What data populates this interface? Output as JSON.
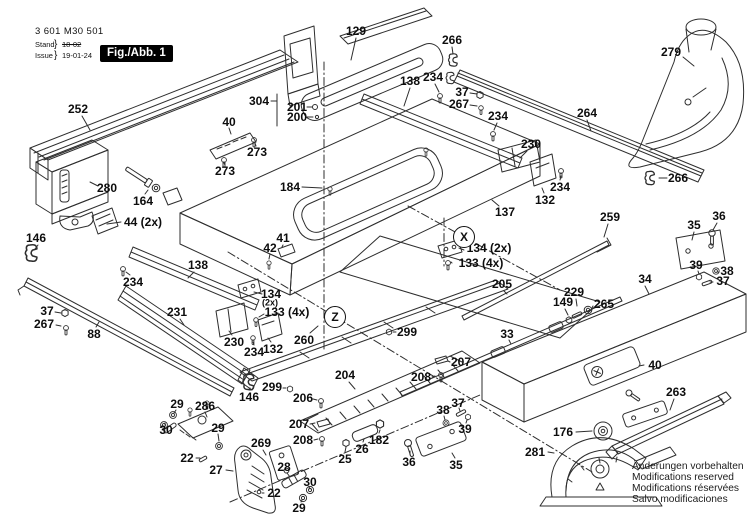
{
  "header": {
    "part_number": "3 601 M30 501",
    "revision": {
      "stand_label": "Stand",
      "issue_label": "Issue",
      "brace": "}",
      "stand_value": "18-02",
      "issue_value": "19-01-24"
    },
    "figure_label": "Fig./Abb. 1"
  },
  "brand": "BOSCH",
  "footer_note": {
    "lines": [
      "Änderungen vorbehalten",
      "Modifications reserved",
      "Modifications réservées",
      "Salvo modificaciones"
    ]
  },
  "view_markers": [
    {
      "letter": "X",
      "x": 464,
      "y": 237
    },
    {
      "letter": "Z",
      "x": 335,
      "y": 317
    }
  ],
  "part_labels": [
    {
      "t": "129",
      "x": 356,
      "y": 31,
      "l": [
        356,
        38,
        351,
        60
      ]
    },
    {
      "t": "266",
      "x": 452,
      "y": 40,
      "l": [
        452,
        47,
        453,
        54
      ]
    },
    {
      "t": "279",
      "x": 671,
      "y": 52,
      "l": [
        683,
        57,
        694,
        66
      ]
    },
    {
      "t": "252",
      "x": 78,
      "y": 109,
      "l": [
        82,
        116,
        90,
        130
      ]
    },
    {
      "t": "304",
      "x": 259,
      "y": 101,
      "l": [
        271,
        101,
        277,
        101
      ],
      "l2": [
        277,
        94,
        277,
        126
      ]
    },
    {
      "t": "201",
      "x": 297,
      "y": 107,
      "l": [
        307,
        107,
        312,
        107
      ]
    },
    {
      "t": "200",
      "x": 297,
      "y": 117,
      "l": [
        307,
        117,
        313,
        117
      ]
    },
    {
      "t": "138",
      "x": 410,
      "y": 81,
      "l": [
        410,
        88,
        404,
        106
      ]
    },
    {
      "t": "234",
      "x": 433,
      "y": 77,
      "l": [
        435,
        84,
        439,
        92
      ]
    },
    {
      "t": "37",
      "x": 462,
      "y": 92,
      "l": [
        470,
        93,
        477,
        94
      ]
    },
    {
      "t": "267",
      "x": 459,
      "y": 104,
      "l": [
        470,
        105,
        477,
        106
      ]
    },
    {
      "t": "234",
      "x": 498,
      "y": 116,
      "l": [
        497,
        123,
        494,
        130
      ]
    },
    {
      "t": "264",
      "x": 587,
      "y": 113,
      "l": [
        587,
        120,
        591,
        131
      ]
    },
    {
      "t": "40",
      "x": 229,
      "y": 122,
      "l": [
        229,
        128,
        231,
        134
      ]
    },
    {
      "t": "273",
      "x": 257,
      "y": 152,
      "l": [
        256,
        146,
        255,
        143
      ]
    },
    {
      "t": "273",
      "x": 225,
      "y": 171,
      "l": [
        225,
        165,
        224,
        163
      ]
    },
    {
      "t": "280",
      "x": 107,
      "y": 188,
      "l": [
        98,
        186,
        90,
        182
      ]
    },
    {
      "t": "164",
      "x": 143,
      "y": 201,
      "l": [
        145,
        194,
        148,
        190
      ]
    },
    {
      "t": "44 (2x)",
      "x": 143,
      "y": 222,
      "l": [
        121,
        222,
        107,
        224
      ]
    },
    {
      "t": "184",
      "x": 290,
      "y": 187,
      "l": [
        302,
        187,
        322,
        188
      ]
    },
    {
      "t": "230",
      "x": 531,
      "y": 144,
      "l": [
        527,
        151,
        520,
        158
      ]
    },
    {
      "t": "234",
      "x": 560,
      "y": 187,
      "l": [
        560,
        180,
        561,
        176
      ]
    },
    {
      "t": "132",
      "x": 545,
      "y": 200,
      "l": [
        544,
        193,
        542,
        188
      ]
    },
    {
      "t": "137",
      "x": 505,
      "y": 212,
      "l": [
        499,
        206,
        492,
        200
      ]
    },
    {
      "t": "266",
      "x": 678,
      "y": 178,
      "l": [
        667,
        178,
        659,
        178
      ]
    },
    {
      "t": "259",
      "x": 610,
      "y": 217,
      "l": [
        608,
        224,
        604,
        237
      ]
    },
    {
      "t": "36",
      "x": 719,
      "y": 216,
      "l": [
        717,
        223,
        713,
        230
      ]
    },
    {
      "t": "35",
      "x": 694,
      "y": 225,
      "l": [
        694,
        232,
        692,
        240
      ]
    },
    {
      "t": "39",
      "x": 696,
      "y": 265,
      "l": [
        698,
        271,
        699,
        274
      ]
    },
    {
      "t": "38",
      "x": 727,
      "y": 271,
      "l": [
        719,
        272,
        717,
        272
      ]
    },
    {
      "t": "37",
      "x": 723,
      "y": 281,
      "l": [
        713,
        282,
        710,
        282
      ]
    },
    {
      "t": "34",
      "x": 645,
      "y": 279,
      "l": [
        645,
        286,
        649,
        294
      ]
    },
    {
      "t": "146",
      "x": 36,
      "y": 238,
      "l": [
        38,
        245,
        35,
        249
      ]
    },
    {
      "t": "138",
      "x": 198,
      "y": 265,
      "l": [
        194,
        272,
        188,
        278
      ]
    },
    {
      "t": "234",
      "x": 133,
      "y": 282,
      "l": [
        130,
        275,
        126,
        272
      ]
    },
    {
      "t": "42",
      "x": 270,
      "y": 248,
      "l": [
        270,
        254,
        269,
        259
      ]
    },
    {
      "t": "41",
      "x": 283,
      "y": 238,
      "l": [
        283,
        245,
        282,
        247
      ]
    },
    {
      "t": "134 (2x)",
      "x": 489,
      "y": 248,
      "l": [
        459,
        248,
        464,
        250
      ]
    },
    {
      "t": "133 (4x)",
      "x": 481,
      "y": 263,
      "l": [
        452,
        263,
        451,
        262
      ]
    },
    {
      "t": "205",
      "x": 502,
      "y": 284,
      "l": [
        504,
        291,
        507,
        294
      ]
    },
    {
      "t": "229",
      "x": 574,
      "y": 292,
      "l": [
        576,
        299,
        577,
        306
      ]
    },
    {
      "t": "149",
      "x": 563,
      "y": 302,
      "l": [
        565,
        309,
        568,
        315
      ]
    },
    {
      "t": "265",
      "x": 604,
      "y": 304,
      "l": [
        593,
        306,
        592,
        308
      ]
    },
    {
      "t": "37",
      "x": 47,
      "y": 311,
      "l": [
        55,
        312,
        61,
        313
      ]
    },
    {
      "t": "267",
      "x": 44,
      "y": 324,
      "l": [
        56,
        325,
        61,
        326
      ]
    },
    {
      "t": "88",
      "x": 94,
      "y": 334,
      "l": [
        96,
        327,
        99,
        322
      ]
    },
    {
      "t": "231",
      "x": 177,
      "y": 312,
      "l": [
        180,
        319,
        184,
        325
      ]
    },
    {
      "t": "134",
      "x": 271,
      "y": 294,
      "l": [
        262,
        294,
        254,
        292
      ]
    },
    {
      "t": "(2x)",
      "x": 270,
      "y": 303,
      "s": true
    },
    {
      "t": "133 (4x)",
      "x": 287,
      "y": 312,
      "l": [
        264,
        314,
        259,
        317
      ]
    },
    {
      "t": "230",
      "x": 234,
      "y": 342,
      "l": [
        232,
        335,
        229,
        331
      ]
    },
    {
      "t": "234",
      "x": 254,
      "y": 352,
      "l": [
        254,
        345,
        253,
        342
      ]
    },
    {
      "t": "132",
      "x": 273,
      "y": 349,
      "l": [
        271,
        342,
        268,
        338
      ]
    },
    {
      "t": "260",
      "x": 304,
      "y": 340,
      "l": [
        310,
        333,
        318,
        326
      ]
    },
    {
      "t": "299",
      "x": 407,
      "y": 332,
      "l": [
        396,
        332,
        393,
        332
      ]
    },
    {
      "t": "299",
      "x": 272,
      "y": 387,
      "l": [
        283,
        388,
        286,
        388
      ]
    },
    {
      "t": "146",
      "x": 249,
      "y": 397,
      "l": [
        249,
        390,
        250,
        388
      ]
    },
    {
      "t": "204",
      "x": 345,
      "y": 375,
      "l": [
        349,
        382,
        355,
        389
      ]
    },
    {
      "t": "206",
      "x": 303,
      "y": 398,
      "l": [
        313,
        399,
        317,
        400
      ]
    },
    {
      "t": "207",
      "x": 299,
      "y": 424,
      "l": [
        310,
        424,
        315,
        423
      ]
    },
    {
      "t": "208",
      "x": 303,
      "y": 440,
      "l": [
        314,
        440,
        318,
        439
      ]
    },
    {
      "t": "207",
      "x": 461,
      "y": 362,
      "l": [
        450,
        362,
        448,
        361
      ]
    },
    {
      "t": "208",
      "x": 421,
      "y": 377,
      "l": [
        432,
        377,
        435,
        376
      ]
    },
    {
      "t": "286",
      "x": 205,
      "y": 406,
      "l": [
        205,
        412,
        207,
        417
      ]
    },
    {
      "t": "29",
      "x": 177,
      "y": 404,
      "l": [
        176,
        410,
        174,
        413
      ]
    },
    {
      "t": "30",
      "x": 166,
      "y": 430,
      "l": [
        165,
        425,
        165,
        423
      ]
    },
    {
      "t": "29",
      "x": 218,
      "y": 428,
      "l": [
        218,
        434,
        219,
        441
      ]
    },
    {
      "t": "22",
      "x": 187,
      "y": 458,
      "l": [
        196,
        458,
        200,
        458
      ]
    },
    {
      "t": "27",
      "x": 216,
      "y": 470,
      "l": [
        226,
        470,
        233,
        471
      ]
    },
    {
      "t": "269",
      "x": 261,
      "y": 443,
      "l": [
        263,
        450,
        266,
        455
      ]
    },
    {
      "t": "28",
      "x": 284,
      "y": 467,
      "l": [
        287,
        473,
        290,
        477
      ]
    },
    {
      "t": "22",
      "x": 274,
      "y": 493,
      "l": [
        264,
        493,
        262,
        493
      ]
    },
    {
      "t": "30",
      "x": 310,
      "y": 482,
      "l": [
        309,
        487,
        310,
        489
      ]
    },
    {
      "t": "29",
      "x": 299,
      "y": 508,
      "l": [
        301,
        502,
        302,
        500
      ]
    },
    {
      "t": "25",
      "x": 345,
      "y": 459,
      "l": [
        345,
        452,
        346,
        447
      ]
    },
    {
      "t": "26",
      "x": 362,
      "y": 449,
      "l": [
        363,
        442,
        364,
        439
      ]
    },
    {
      "t": "182",
      "x": 379,
      "y": 440,
      "l": [
        379,
        433,
        380,
        430
      ]
    },
    {
      "t": "36",
      "x": 409,
      "y": 462,
      "l": [
        410,
        455,
        410,
        451
      ]
    },
    {
      "t": "35",
      "x": 456,
      "y": 465,
      "l": [
        455,
        458,
        452,
        453
      ]
    },
    {
      "t": "38",
      "x": 443,
      "y": 410,
      "l": [
        444,
        416,
        445,
        420
      ]
    },
    {
      "t": "37",
      "x": 458,
      "y": 403,
      "l": [
        459,
        408,
        460,
        411
      ]
    },
    {
      "t": "39",
      "x": 465,
      "y": 429,
      "l": [
        466,
        423,
        467,
        420
      ]
    },
    {
      "t": "176",
      "x": 563,
      "y": 432,
      "l": [
        576,
        432,
        592,
        431
      ]
    },
    {
      "t": "281",
      "x": 535,
      "y": 452,
      "l": [
        548,
        452,
        554,
        453
      ]
    },
    {
      "t": "263",
      "x": 676,
      "y": 392,
      "l": [
        674,
        399,
        670,
        410
      ]
    },
    {
      "t": "40",
      "x": 655,
      "y": 365,
      "l": [
        644,
        365,
        639,
        366
      ]
    },
    {
      "t": "33",
      "x": 507,
      "y": 334,
      "l": [
        509,
        340,
        511,
        344
      ]
    }
  ]
}
